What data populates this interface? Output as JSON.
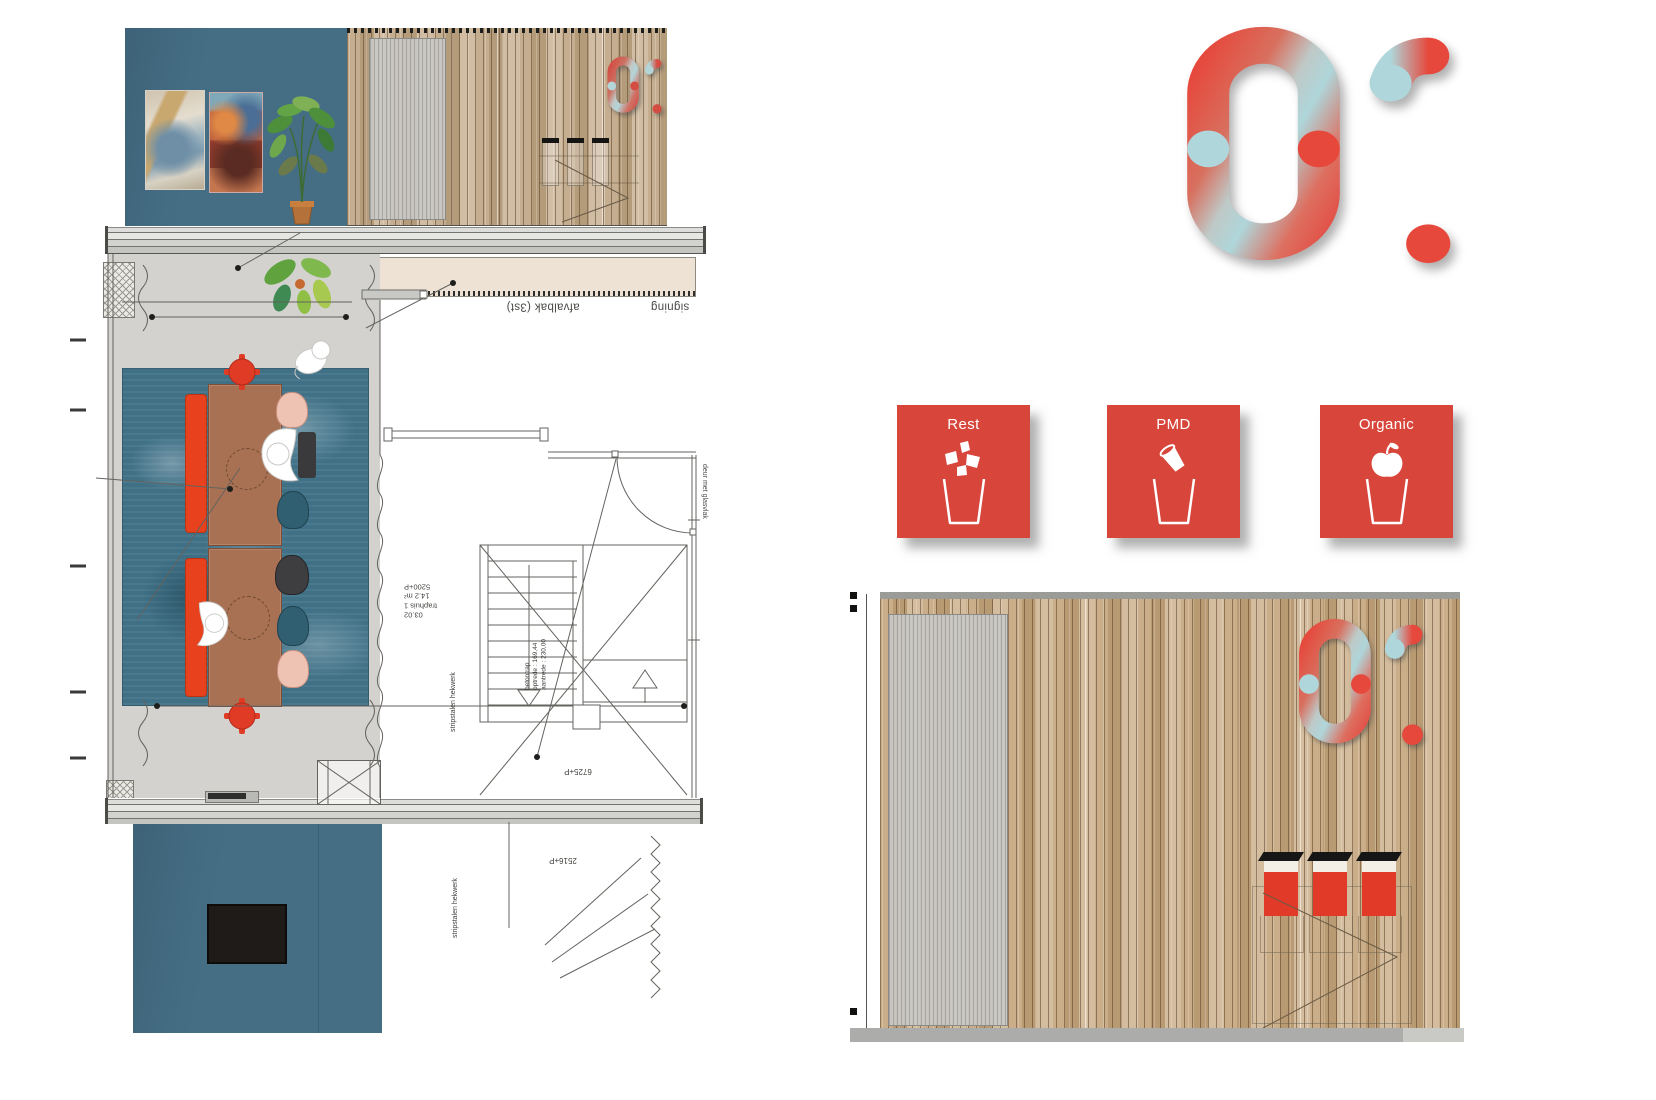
{
  "sheet": {
    "big_number": "01",
    "wall_signage_number": "01"
  },
  "waste_cards": {
    "items": [
      {
        "label": "Rest",
        "icon": "rest-scraps-icon"
      },
      {
        "label": "PMD",
        "icon": "pmd-cup-icon"
      },
      {
        "label": "Organic",
        "icon": "organic-apple-icon"
      }
    ],
    "card_color": "#D7453B"
  },
  "plan": {
    "labels": {
      "afvalbak": "afvalbak (3st)",
      "signing": "signing",
      "room_code": "03.02",
      "room_name": "traphuis 1",
      "room_area": "14.2 m²",
      "level_top": "5200+P",
      "level_stair": "6725+P",
      "level_bottom": "2516+P",
      "door_note": "deur met glasvlak",
      "fence_note_stair": "stripstalen hekwerk",
      "fence_note_bottom": "stripstalen hekwerk",
      "stair_note_1": "betontrap",
      "stair_note_2": "optrede : 169,44",
      "stair_note_3": "aantrede : 230,00"
    }
  },
  "colors": {
    "teal_wall": "#456E85",
    "card_red": "#D7453B",
    "bin_red": "#E23A28",
    "bench_red": "#E8411D",
    "number_red": "#E6483C",
    "number_blue": "#AFD6DA",
    "wood": "#C9AE89",
    "floor_gray": "#D3D2CF",
    "rug_blue": "#3F7086",
    "table_brown": "#A97154"
  }
}
